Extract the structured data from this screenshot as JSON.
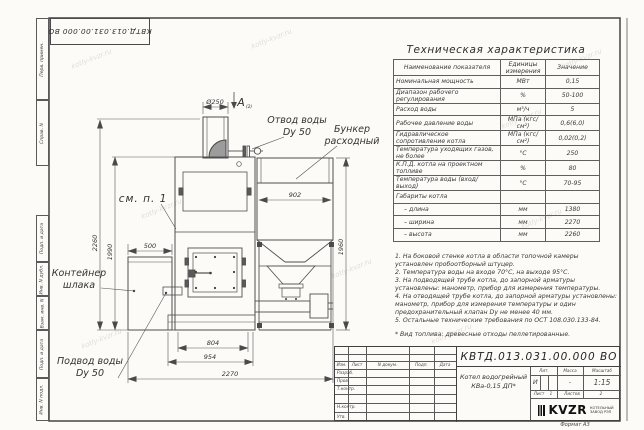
{
  "sheet": {
    "format_label": "Формат А3",
    "watermark": "kotly-kvzr.ru",
    "margin_labels": [
      "Перв. примен.",
      "Справ. N",
      "Подп. и дата",
      "Инв. N дубл.",
      "Взам. инв. N",
      "Подп. и дата",
      "Инв. N подл."
    ]
  },
  "drawing": {
    "view_label": "А",
    "view_ref": "(2)",
    "labels": {
      "see_note": "см. п. 1",
      "water_outlet_1": "Отвод воды",
      "water_outlet_2": "Dy 50",
      "hopper_1": "Бункер",
      "hopper_2": "расходный",
      "slag_1": "Контейнер",
      "slag_2": "шлака",
      "water_inlet_1": "Подвод воды",
      "water_inlet_2": "Dy 50"
    },
    "dimensions": {
      "chimney_diameter": "Ø250",
      "hopper_width": "902",
      "hopper_height": "1960",
      "total_height": "2260",
      "boiler_height": "1990",
      "slag_container_width": "500",
      "furnace_width": "804",
      "base_width": "954",
      "total_width": "2270"
    }
  },
  "spec_table": {
    "title": "Техническая характеристика",
    "headers": [
      "Наименование показателя",
      "Единицы измерения",
      "Значение"
    ],
    "rows": [
      [
        "Номинальная мощность",
        "МВт",
        "0,15"
      ],
      [
        "Диапазон рабочего регулирования",
        "%",
        "50-100"
      ],
      [
        "Расход воды",
        "м³/ч",
        "5"
      ],
      [
        "Рабочее давление воды",
        "МПа (кгс/см²)",
        "0,6(6,0)"
      ],
      [
        "Гидравлическое сопротивление котла",
        "МПа (кгс/см²)",
        "0,02(0,2)"
      ],
      [
        "Температура уходящих газов, не более",
        "°С",
        "250"
      ],
      [
        "К.П.Д. котла на проектном топливе",
        "%",
        "80"
      ],
      [
        "Температура воды (вход/выход)",
        "°С",
        "70-95"
      ],
      [
        "Габариты котла",
        "",
        ""
      ],
      [
        "– длина",
        "мм",
        "1380"
      ],
      [
        "– ширина",
        "мм",
        "2270"
      ],
      [
        "– высота",
        "мм",
        "2260"
      ]
    ]
  },
  "notes": {
    "items": [
      "1. На боковой стенке котла в области топочной камеры установлен пробоотборный штуцер.",
      "2. Температура воды на входе 70°С, на выходе 95°С.",
      "3. На подводящей трубе котла, до запорной арматуры установлены: манометр, прибор для измерения температуры.",
      "4. На отводящей трубе котла, до запорной арматуры установлены: манометр, прибор для измерения температуры и один предохранительный клапан Dу не менее 40 мм.",
      "5. Остальные технические требования по ОСТ 108.030.133-84."
    ],
    "fuel": "* Вид топлива: древесные отходы пеллетированные."
  },
  "title_block": {
    "doc_number": "КВТД.013.031.00.000 ВО",
    "header_cells": [
      "Изм.",
      "Лист",
      "N докум.",
      "Подп.",
      "Дата"
    ],
    "row_labels": [
      "Разраб.",
      "Пров.",
      "Т.контр.",
      "",
      "Н.контр.",
      "Утв."
    ],
    "product_name_1": "Котел водогрейный",
    "product_name_2": "КВа-0,15 ДП*",
    "lit_label": "Лит.",
    "mass_label": "Масса",
    "scale_label": "Масштаб",
    "lit_value": "И",
    "mass_value": "-",
    "scale_value": "1:15",
    "sheet_label": "Лист",
    "sheet_value": "1",
    "sheets_label": "Листов",
    "sheets_value": "2",
    "logo_text": "KVZR",
    "company_1": "КОТЕЛЬНЫЙ",
    "company_2": "ЗАВОД РЭП"
  }
}
